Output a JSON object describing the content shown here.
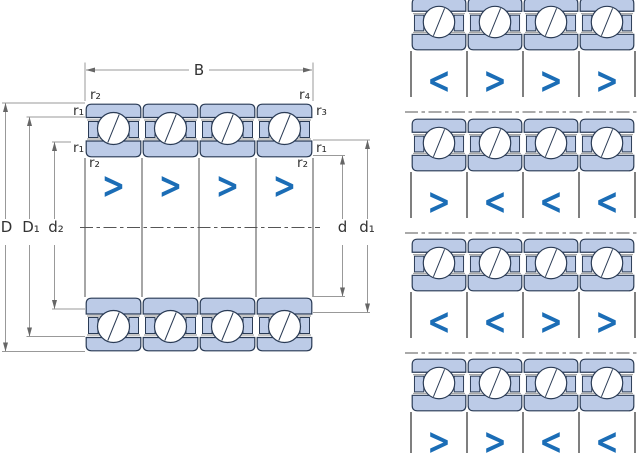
{
  "main_diagram": {
    "labels": {
      "B": "B",
      "D": "D",
      "D1": "D₁",
      "d2": "d₂",
      "d": "d",
      "d1": "d₁",
      "r2_top_left": "r₂",
      "r1_left_upper": "r₁",
      "r1_left_lower": "r₁",
      "r2_bottom_left": "r₂",
      "r4_top_right": "r₄",
      "r3_right_upper": "r₃",
      "r1_right_lower": "r₁",
      "r2_bottom_right": "r₂"
    },
    "chevrons": [
      ">",
      ">",
      ">",
      ">"
    ]
  },
  "arrangement": {
    "rows": [
      {
        "chevrons": [
          "<",
          ">",
          ">",
          ">"
        ]
      },
      {
        "chevrons": [
          ">",
          "<",
          "<",
          "<"
        ]
      },
      {
        "chevrons": [
          "<",
          "<",
          ">",
          ">"
        ]
      },
      {
        "chevrons": [
          ">",
          ">",
          "<",
          "<"
        ]
      }
    ]
  },
  "colors": {
    "ring_fill": "#bccbe7",
    "outline_navy": "#2a3b55",
    "chevron_blue": "#1b6db6",
    "dimension_gray": "#999999",
    "text": "#333333"
  }
}
